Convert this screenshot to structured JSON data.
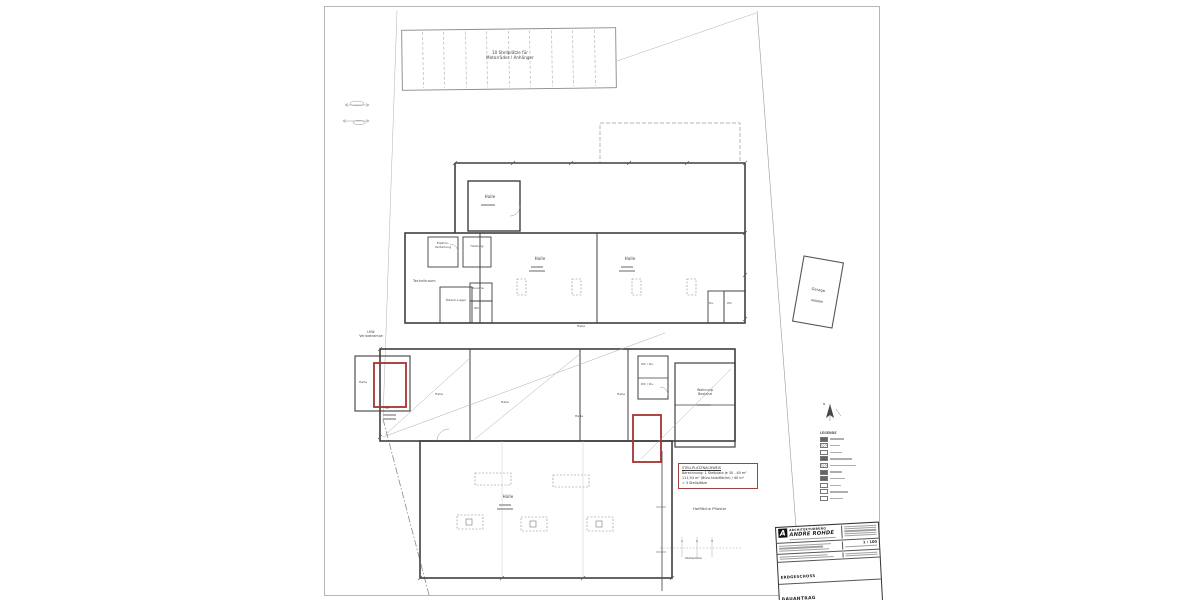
{
  "drawing": {
    "parking_label": "10 Stellplätze für\nMotorräder / Anhänger",
    "rooms": {
      "halle": "Halle",
      "elektro": "Elektro-\nVerteilung",
      "heizung": "Heizung",
      "technikraum": "Technikraum",
      "oeltank_lager": "Öltank-Lager",
      "dusche": "Dusche",
      "wc": "WC",
      "du_short": "Du.",
      "wc_du": "WC / Du.",
      "wohnung": "Wohnung\nBestand",
      "lkw_rampe": "LKW\nVerladerampe",
      "tor": "Tor",
      "garage": "Garage"
    },
    "site": {
      "hofflaeche": "Hoffläche Pflaster",
      "stellplaetze": "Stellplätze",
      "stall_numbers": [
        "1",
        "2",
        "3"
      ],
      "north": "N"
    },
    "note": {
      "title": "STELLPLATZNACHWEIS",
      "line1": "Berechnung: 1 Stellplatz je 30 - 40 m²",
      "line2": "111,94 m² (Büro-Nutzfläche) / 40 m²",
      "line3": "=  3 Stellplätze"
    },
    "legend": {
      "title": "LEGENDE"
    },
    "title_block": {
      "firm_line1": "ARCHITEKTURBÜRO",
      "firm_line2": "ANDRE ROHDE",
      "scale": "1 : 100",
      "floor": "ERDGESCHOSS",
      "doc_type": "BAUANTRAG"
    }
  }
}
